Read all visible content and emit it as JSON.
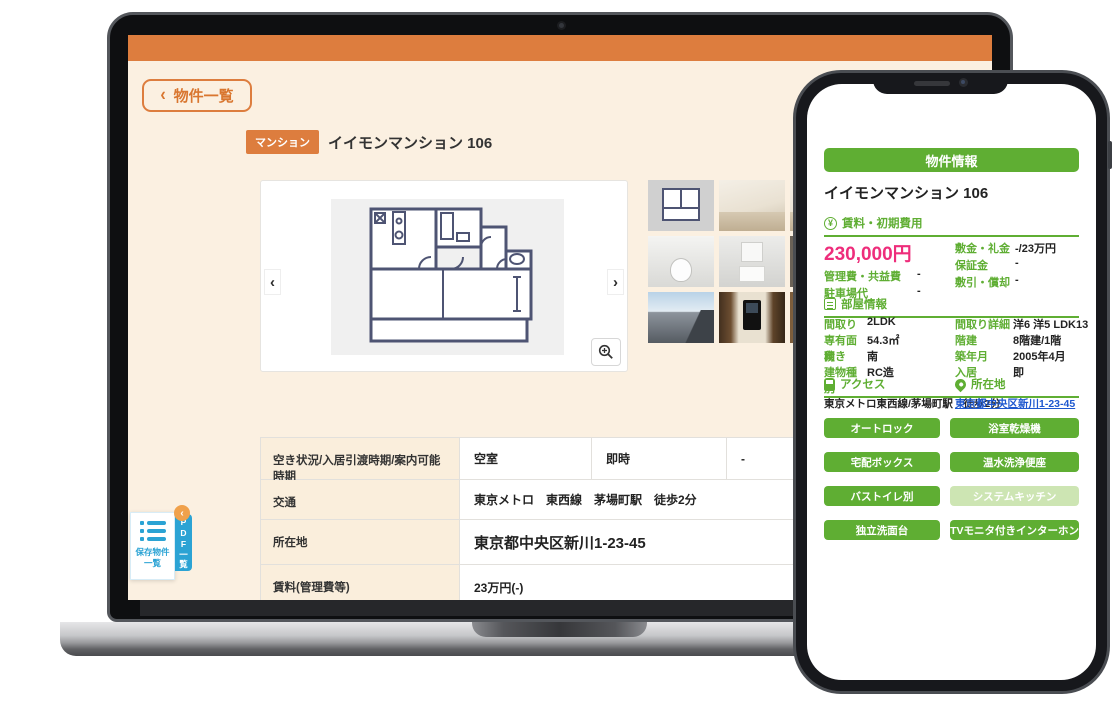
{
  "icons": {
    "back": "‹",
    "prev": "‹",
    "next": "›",
    "collapse": "‹",
    "yen": "¥"
  },
  "laptop": {
    "back_button_label": "物件一覧",
    "badge": "マンション",
    "title": "イイモンマンション 106",
    "table": {
      "rows": [
        {
          "label": "空き状況/入居引渡時期/案内可能時期",
          "cells": [
            "空室",
            "即時",
            "-"
          ]
        },
        {
          "label": "交通",
          "value": "東京メトロ　東西線　茅場町駅　徒歩2分"
        },
        {
          "label": "所在地",
          "value": "東京都中央区新川1-23-45"
        },
        {
          "label": "賃料(管理費等)",
          "value": "23万円(-)"
        }
      ]
    },
    "saved_widget": {
      "label": "保存物件一覧",
      "tab_label": "PDF一覧"
    }
  },
  "phone": {
    "header_button": "物件情報",
    "title": "イイモンマンション 106",
    "rent_section": {
      "heading": "賃料・初期費用",
      "price": "230,000円",
      "left": [
        {
          "label": "管理費・共益費",
          "value": "-"
        },
        {
          "label": "駐車場代",
          "value": "-"
        }
      ],
      "right": [
        {
          "label": "敷金・礼金",
          "value": "-/23万円"
        },
        {
          "label": "保証金",
          "value": "-"
        },
        {
          "label": "敷引・償却",
          "value": "-"
        }
      ]
    },
    "room_section": {
      "heading": "部屋情報",
      "pairs": [
        {
          "label": "間取り",
          "value": "2LDK"
        },
        {
          "label": "間取り詳細",
          "value": "洋6 洋5 LDK13"
        },
        {
          "label": "専有面積",
          "value": "54.3㎡"
        },
        {
          "label": "階建",
          "value": "8階建/1階"
        },
        {
          "label": "向き",
          "value": "南"
        },
        {
          "label": "築年月",
          "value": "2005年4月"
        },
        {
          "label": "建物種別",
          "value": "RC造"
        },
        {
          "label": "入居",
          "value": "即"
        }
      ]
    },
    "access_section": {
      "heading_access": "アクセス",
      "heading_location": "所在地",
      "access_text": "東京メトロ東西線/茅場町駅　徒歩2分",
      "location_link": "東京都中央区新川1-23-45"
    },
    "features": [
      {
        "label": "オートロック",
        "enabled": true
      },
      {
        "label": "浴室乾燥機",
        "enabled": true
      },
      {
        "label": "宅配ボックス",
        "enabled": true
      },
      {
        "label": "温水洗浄便座",
        "enabled": true
      },
      {
        "label": "バストイレ別",
        "enabled": true
      },
      {
        "label": "システムキッチン",
        "enabled": false
      },
      {
        "label": "独立洗面台",
        "enabled": true
      },
      {
        "label": "TVモニタ付きインターホン",
        "enabled": true
      }
    ]
  },
  "colors": {
    "accent_orange": "#dd7d3e",
    "cream_bg": "#fbf0e1",
    "green": "#5fae33",
    "green_disabled": "#cde5b3",
    "price_pink": "#ee2d7b",
    "sidebar_blue": "#2ba3d4",
    "link_blue": "#1e58cf"
  }
}
